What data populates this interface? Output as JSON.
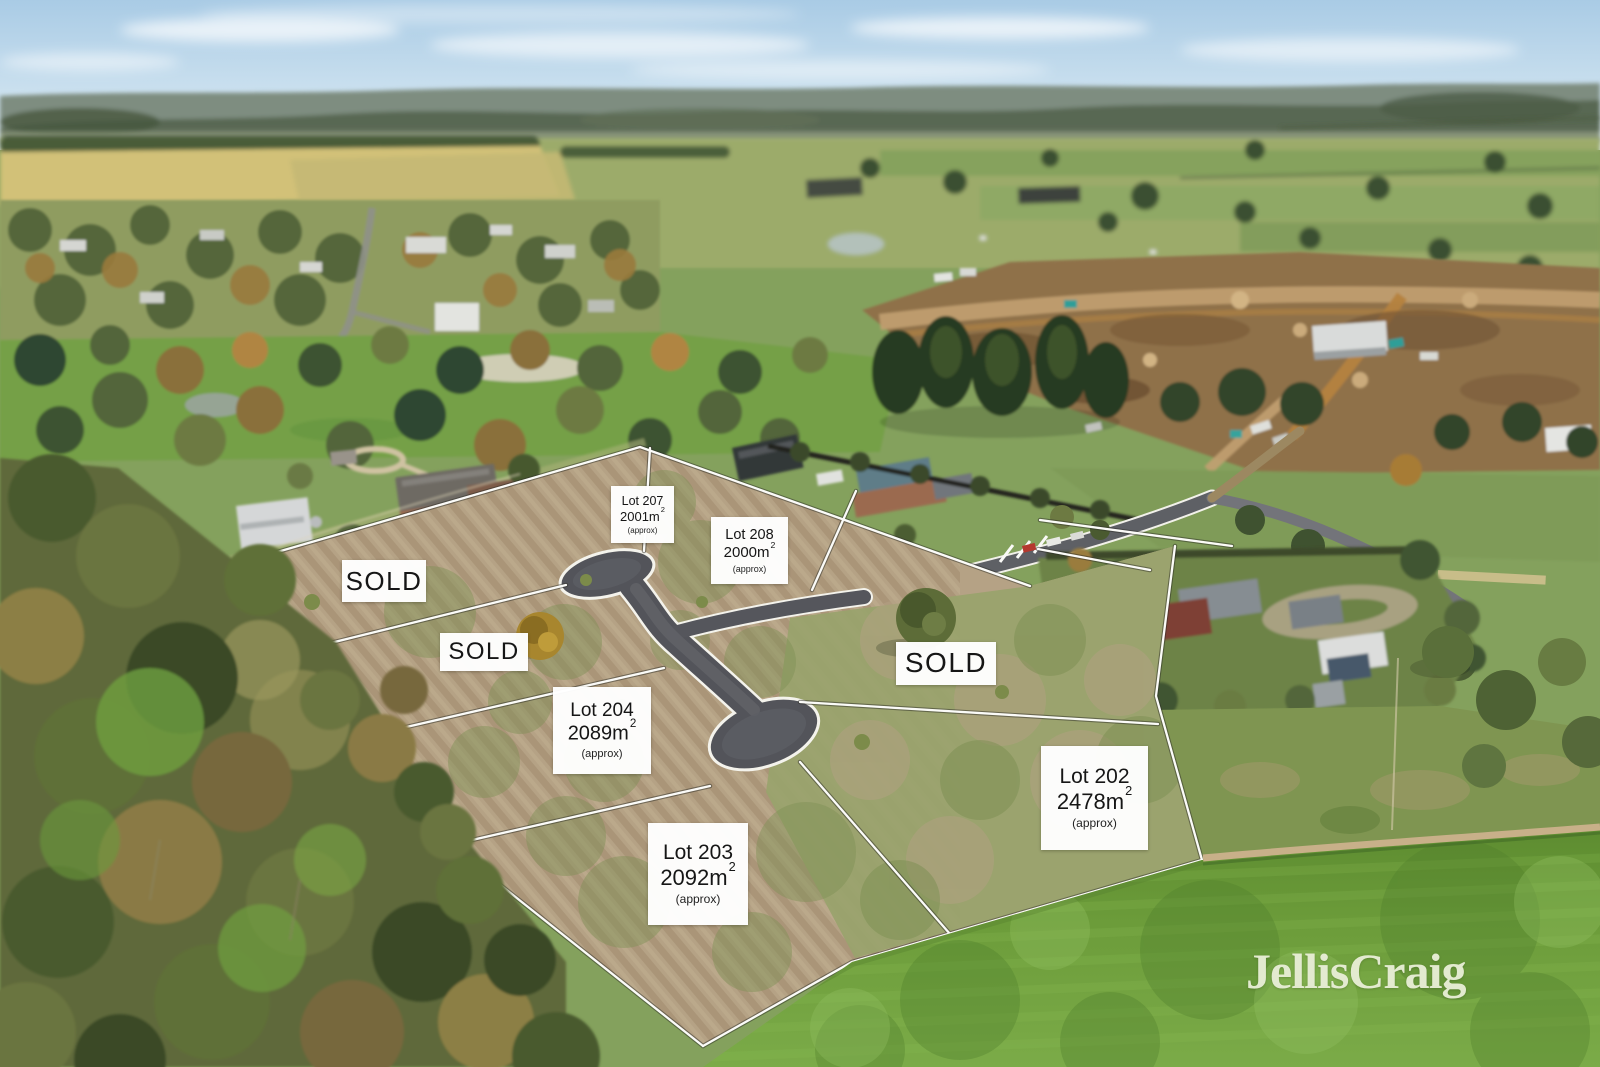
{
  "branding": {
    "watermark": "JellisCraig"
  },
  "colors": {
    "label_background": "#ffffff",
    "label_text": "#161616",
    "watermark_text": "#eaefd8",
    "boundary_line": "#fbfbf8",
    "new_road_asphalt": "#54555b"
  },
  "sold_labels": [
    {
      "text": "SOLD"
    },
    {
      "text": "SOLD"
    },
    {
      "text": "SOLD"
    }
  ],
  "lot_labels": [
    {
      "id": "lot-207",
      "name": "Lot 207",
      "area": "2001m",
      "area_sup": "2",
      "qualifier": "(approx)"
    },
    {
      "id": "lot-208",
      "name": "Lot 208",
      "area": "2000m",
      "area_sup": "2",
      "qualifier": "(approx)"
    },
    {
      "id": "lot-204",
      "name": "Lot 204",
      "area": "2089m",
      "area_sup": "2",
      "qualifier": "(approx)"
    },
    {
      "id": "lot-203",
      "name": "Lot 203",
      "area": "2092m",
      "area_sup": "2",
      "qualifier": "(approx)"
    },
    {
      "id": "lot-202",
      "name": "Lot 202",
      "area": "2478m",
      "area_sup": "2",
      "qualifier": "(approx)"
    }
  ]
}
